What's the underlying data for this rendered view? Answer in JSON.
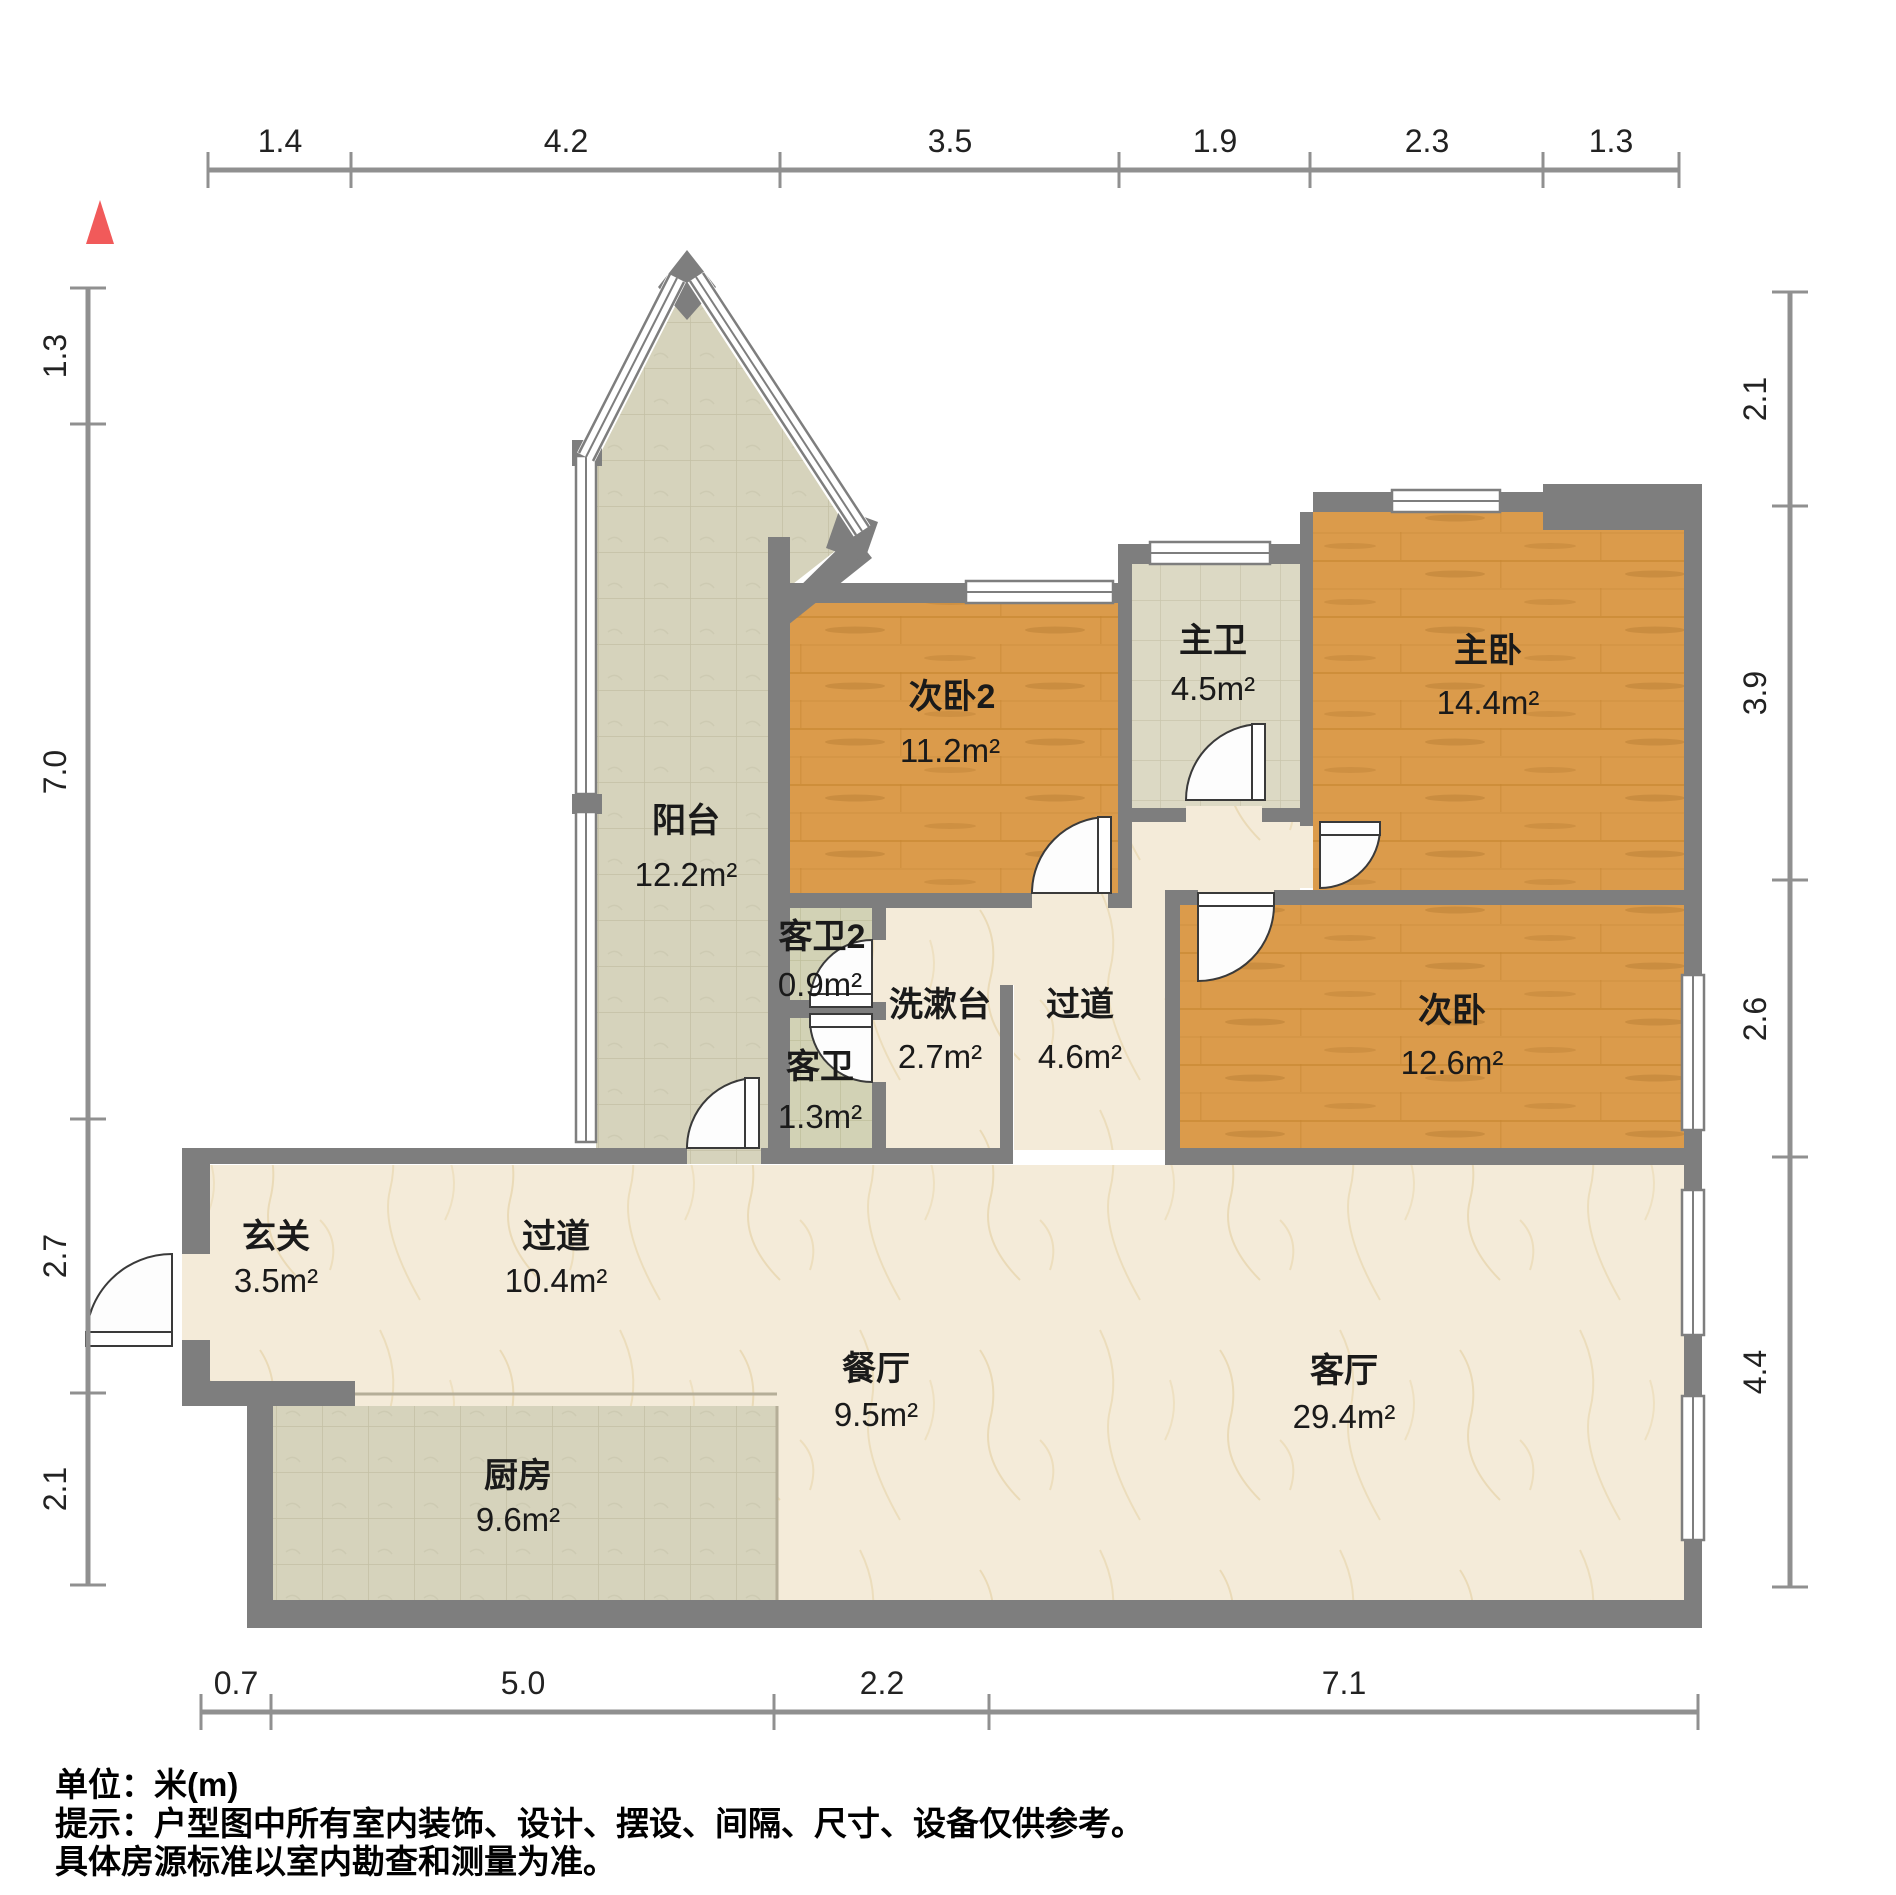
{
  "rulers": {
    "top": [
      "1.4",
      "4.2",
      "3.5",
      "1.9",
      "2.3",
      "1.3"
    ],
    "bottom": [
      "0.7",
      "5.0",
      "2.2",
      "7.1"
    ],
    "left": [
      "1.3",
      "7.0",
      "2.7",
      "2.1"
    ],
    "right": [
      "2.1",
      "3.9",
      "2.6",
      "4.4"
    ]
  },
  "rooms": [
    {
      "name": "阳台",
      "area": "12.2m²"
    },
    {
      "name": "次卧2",
      "area": "11.2m²"
    },
    {
      "name": "主卫",
      "area": "4.5m²"
    },
    {
      "name": "主卧",
      "area": "14.4m²"
    },
    {
      "name": "次卧",
      "area": "12.6m²"
    },
    {
      "name": "客卫2",
      "area": "0.9m²"
    },
    {
      "name": "洗漱台",
      "area": "2.7m²"
    },
    {
      "name": "过道",
      "area": "4.6m²"
    },
    {
      "name": "客卫",
      "area": "1.3m²"
    },
    {
      "name": "玄关",
      "area": "3.5m²"
    },
    {
      "name": "过道",
      "area": "10.4m²"
    },
    {
      "name": "餐厅",
      "area": "9.5m²"
    },
    {
      "name": "客厅",
      "area": "29.4m²"
    },
    {
      "name": "厨房",
      "area": "9.6m²"
    }
  ],
  "footer": {
    "line1": "单位：米(m)",
    "line2": "提示：户型图中所有室内装饰、设计、摆设、间隔、尺寸、设备仅供参考。",
    "line3": "具体房源标准以室内勘查和测量为准。"
  },
  "colors": {
    "wall": "#7e7e7e",
    "wood": "#db9b4b",
    "tile_balcony": "#d6d3bc",
    "tile_bath": "#dcd9c4",
    "tile_small_bath": "#d2d2b5",
    "marble": "#f4ebd9",
    "north_arrow": "#f15a5a"
  }
}
